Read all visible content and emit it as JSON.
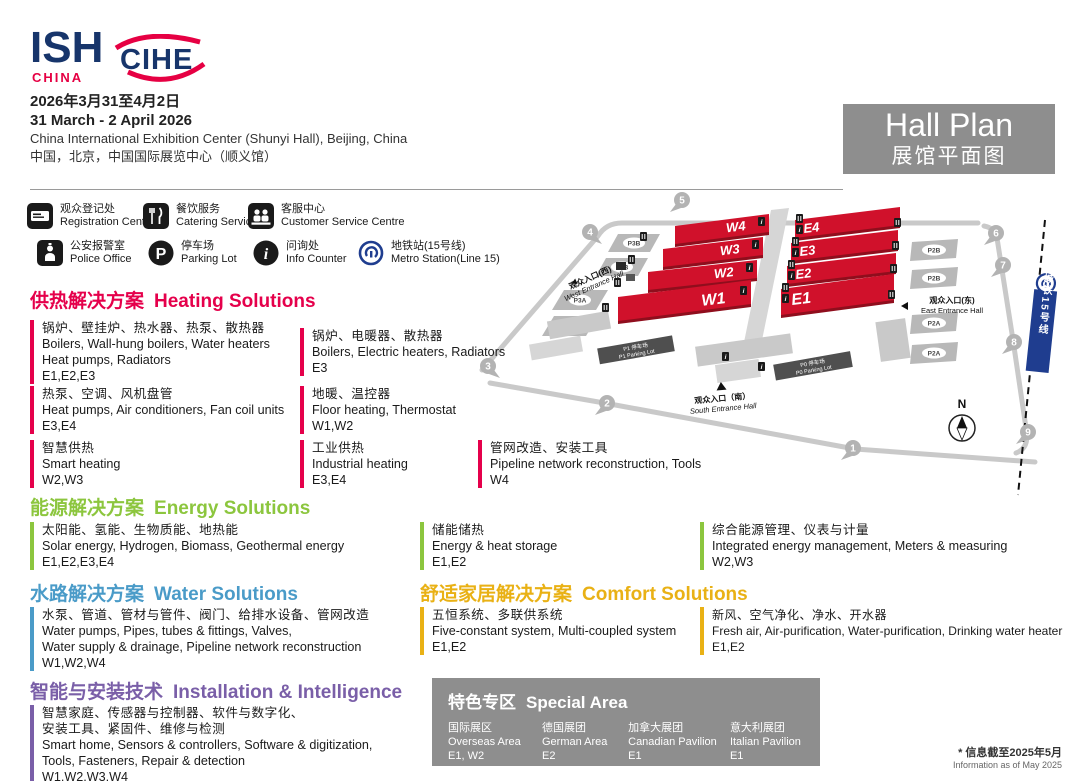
{
  "header": {
    "logo_ish": "ISH",
    "logo_ish_sub": "CHINA",
    "logo_cihe": "CIHE",
    "date_cn": "2026年3月31至4月2日",
    "date_en": "31 March - 2 April 2026",
    "venue_en": "China International Exhibition Center (Shunyi Hall), Beijing, China",
    "venue_cn": "中国，北京，中国国际展览中心（顺义馆）",
    "hall_plan_en": "Hall Plan",
    "hall_plan_cn": "展馆平面图"
  },
  "legend": {
    "row1": [
      {
        "icon": "registration-icon",
        "cn": "观众登记处",
        "en": "Registration Centre"
      },
      {
        "icon": "catering-icon",
        "cn": "餐饮服务",
        "en": "Catering Service"
      },
      {
        "icon": "customer-service-icon",
        "cn": "客服中心",
        "en": "Customer Service Centre"
      }
    ],
    "row2": [
      {
        "icon": "police-icon",
        "cn": "公安报警室",
        "en": "Police Office"
      },
      {
        "icon": "parking-icon",
        "cn": "停车场",
        "en": "Parking Lot"
      },
      {
        "icon": "info-icon",
        "cn": "问询处",
        "en": "Info Counter"
      },
      {
        "icon": "metro-icon",
        "cn": "地铁站(15号线)",
        "en": "Metro Station(Line 15)"
      }
    ]
  },
  "map": {
    "halls_west": [
      "W4",
      "W3",
      "W2",
      "W1"
    ],
    "halls_east": [
      "E4",
      "E3",
      "E2",
      "E1"
    ],
    "parking_west": [
      "P3B",
      "P3B",
      "P3A",
      "P3A"
    ],
    "parking_east": [
      "P2B",
      "P2B",
      "P2A",
      "P2A"
    ],
    "entrances": {
      "west_cn": "观众入口(西)",
      "west_en": "West Entrance Hall",
      "east_cn": "观众入口(东)",
      "east_en": "East Entrance Hall",
      "south_cn": "观众入口（南）",
      "south_en": "South Entrance Hall"
    },
    "parking_labels": {
      "p1_cn": "P1 停车场",
      "p1_en": "P1 Parking Lot",
      "p0_cn": "P0 停车场",
      "p0_en": "P0 Parking Lot"
    },
    "metro_line_cn": "城铁15号线",
    "compass_n": "N",
    "gates": [
      "1",
      "2",
      "3",
      "4",
      "5",
      "6",
      "7",
      "8",
      "9"
    ]
  },
  "sections": {
    "heating": {
      "title_cn": "供热解决方案",
      "title_en": "Heating Solutions",
      "items": [
        {
          "cn": "锅炉、壁挂炉、热水器、热泵、散热器",
          "en": "Boilers, Wall-hung boilers, Water heaters",
          "en2": "Heat pumps, Radiators",
          "halls": "E1,E2,E3"
        },
        {
          "cn": "热泵、空调、风机盘管",
          "en": "Heat pumps, Air conditioners, Fan coil units",
          "halls": "E3,E4"
        },
        {
          "cn": "智慧供热",
          "en": "Smart heating",
          "halls": "W2,W3"
        },
        {
          "cn": "锅炉、电暖器、散热器",
          "en": "Boilers, Electric heaters, Radiators",
          "halls": "E3"
        },
        {
          "cn": "地暖、温控器",
          "en": "Floor heating, Thermostat",
          "halls": "W1,W2"
        },
        {
          "cn": "工业供热",
          "en": "Industrial heating",
          "halls": "E3,E4"
        },
        {
          "cn": "管网改造、安装工具",
          "en": "Pipeline network reconstruction, Tools",
          "halls": "W4"
        }
      ]
    },
    "energy": {
      "title_cn": "能源解决方案",
      "title_en": "Energy Solutions",
      "items": [
        {
          "cn": "太阳能、氢能、生物质能、地热能",
          "en": "Solar energy, Hydrogen, Biomass, Geothermal energy",
          "halls": "E1,E2,E3,E4"
        },
        {
          "cn": "储能储热",
          "en": "Energy & heat storage",
          "halls": "E1,E2"
        },
        {
          "cn": "综合能源管理、仪表与计量",
          "en": "Integrated energy management, Meters & measuring",
          "halls": "W2,W3"
        }
      ]
    },
    "water": {
      "title_cn": "水路解决方案",
      "title_en": "Water Solutions",
      "items": [
        {
          "cn": "水泵、管道、管材与管件、阀门、给排水设备、管网改造",
          "en": "Water pumps, Pipes, tubes & fittings, Valves,",
          "en2": "Water supply & drainage, Pipeline network reconstruction",
          "halls": "W1,W2,W4"
        }
      ]
    },
    "comfort": {
      "title_cn": "舒适家居解决方案",
      "title_en": "Comfort Solutions",
      "items": [
        {
          "cn": "五恒系统、多联供系统",
          "en": "Five-constant system, Multi-coupled system",
          "halls": "E1,E2"
        },
        {
          "cn": "新风、空气净化、净水、开水器",
          "en": "Fresh air, Air-purification, Water-purification, Drinking water heater",
          "halls": "E1,E2"
        }
      ]
    },
    "intelligence": {
      "title_cn": "智能与安装技术",
      "title_en": "Installation & Intelligence",
      "items": [
        {
          "cn": "智慧家庭、传感器与控制器、软件与数字化、",
          "cn2": "安装工具、紧固件、维修与检测",
          "en": "Smart home, Sensors & controllers, Software & digitization,",
          "en2": "Tools, Fasteners, Repair & detection",
          "halls": "W1,W2,W3,W4"
        }
      ]
    }
  },
  "special_area": {
    "title_cn": "特色专区",
    "title_en": "Special Area",
    "columns": [
      {
        "cn": "国际展区",
        "en": "Overseas Area",
        "halls": "E1, W2"
      },
      {
        "cn": "德国展团",
        "en": "German Area",
        "halls": "E2"
      },
      {
        "cn": "加拿大展团",
        "en": "Canadian Pavilion",
        "halls": "E1"
      },
      {
        "cn": "意大利展团",
        "en": "Italian Pavilion",
        "halls": "E1"
      }
    ]
  },
  "footnote": {
    "cn": "* 信息截至2025年5月",
    "en": "Information as of May 2025"
  }
}
